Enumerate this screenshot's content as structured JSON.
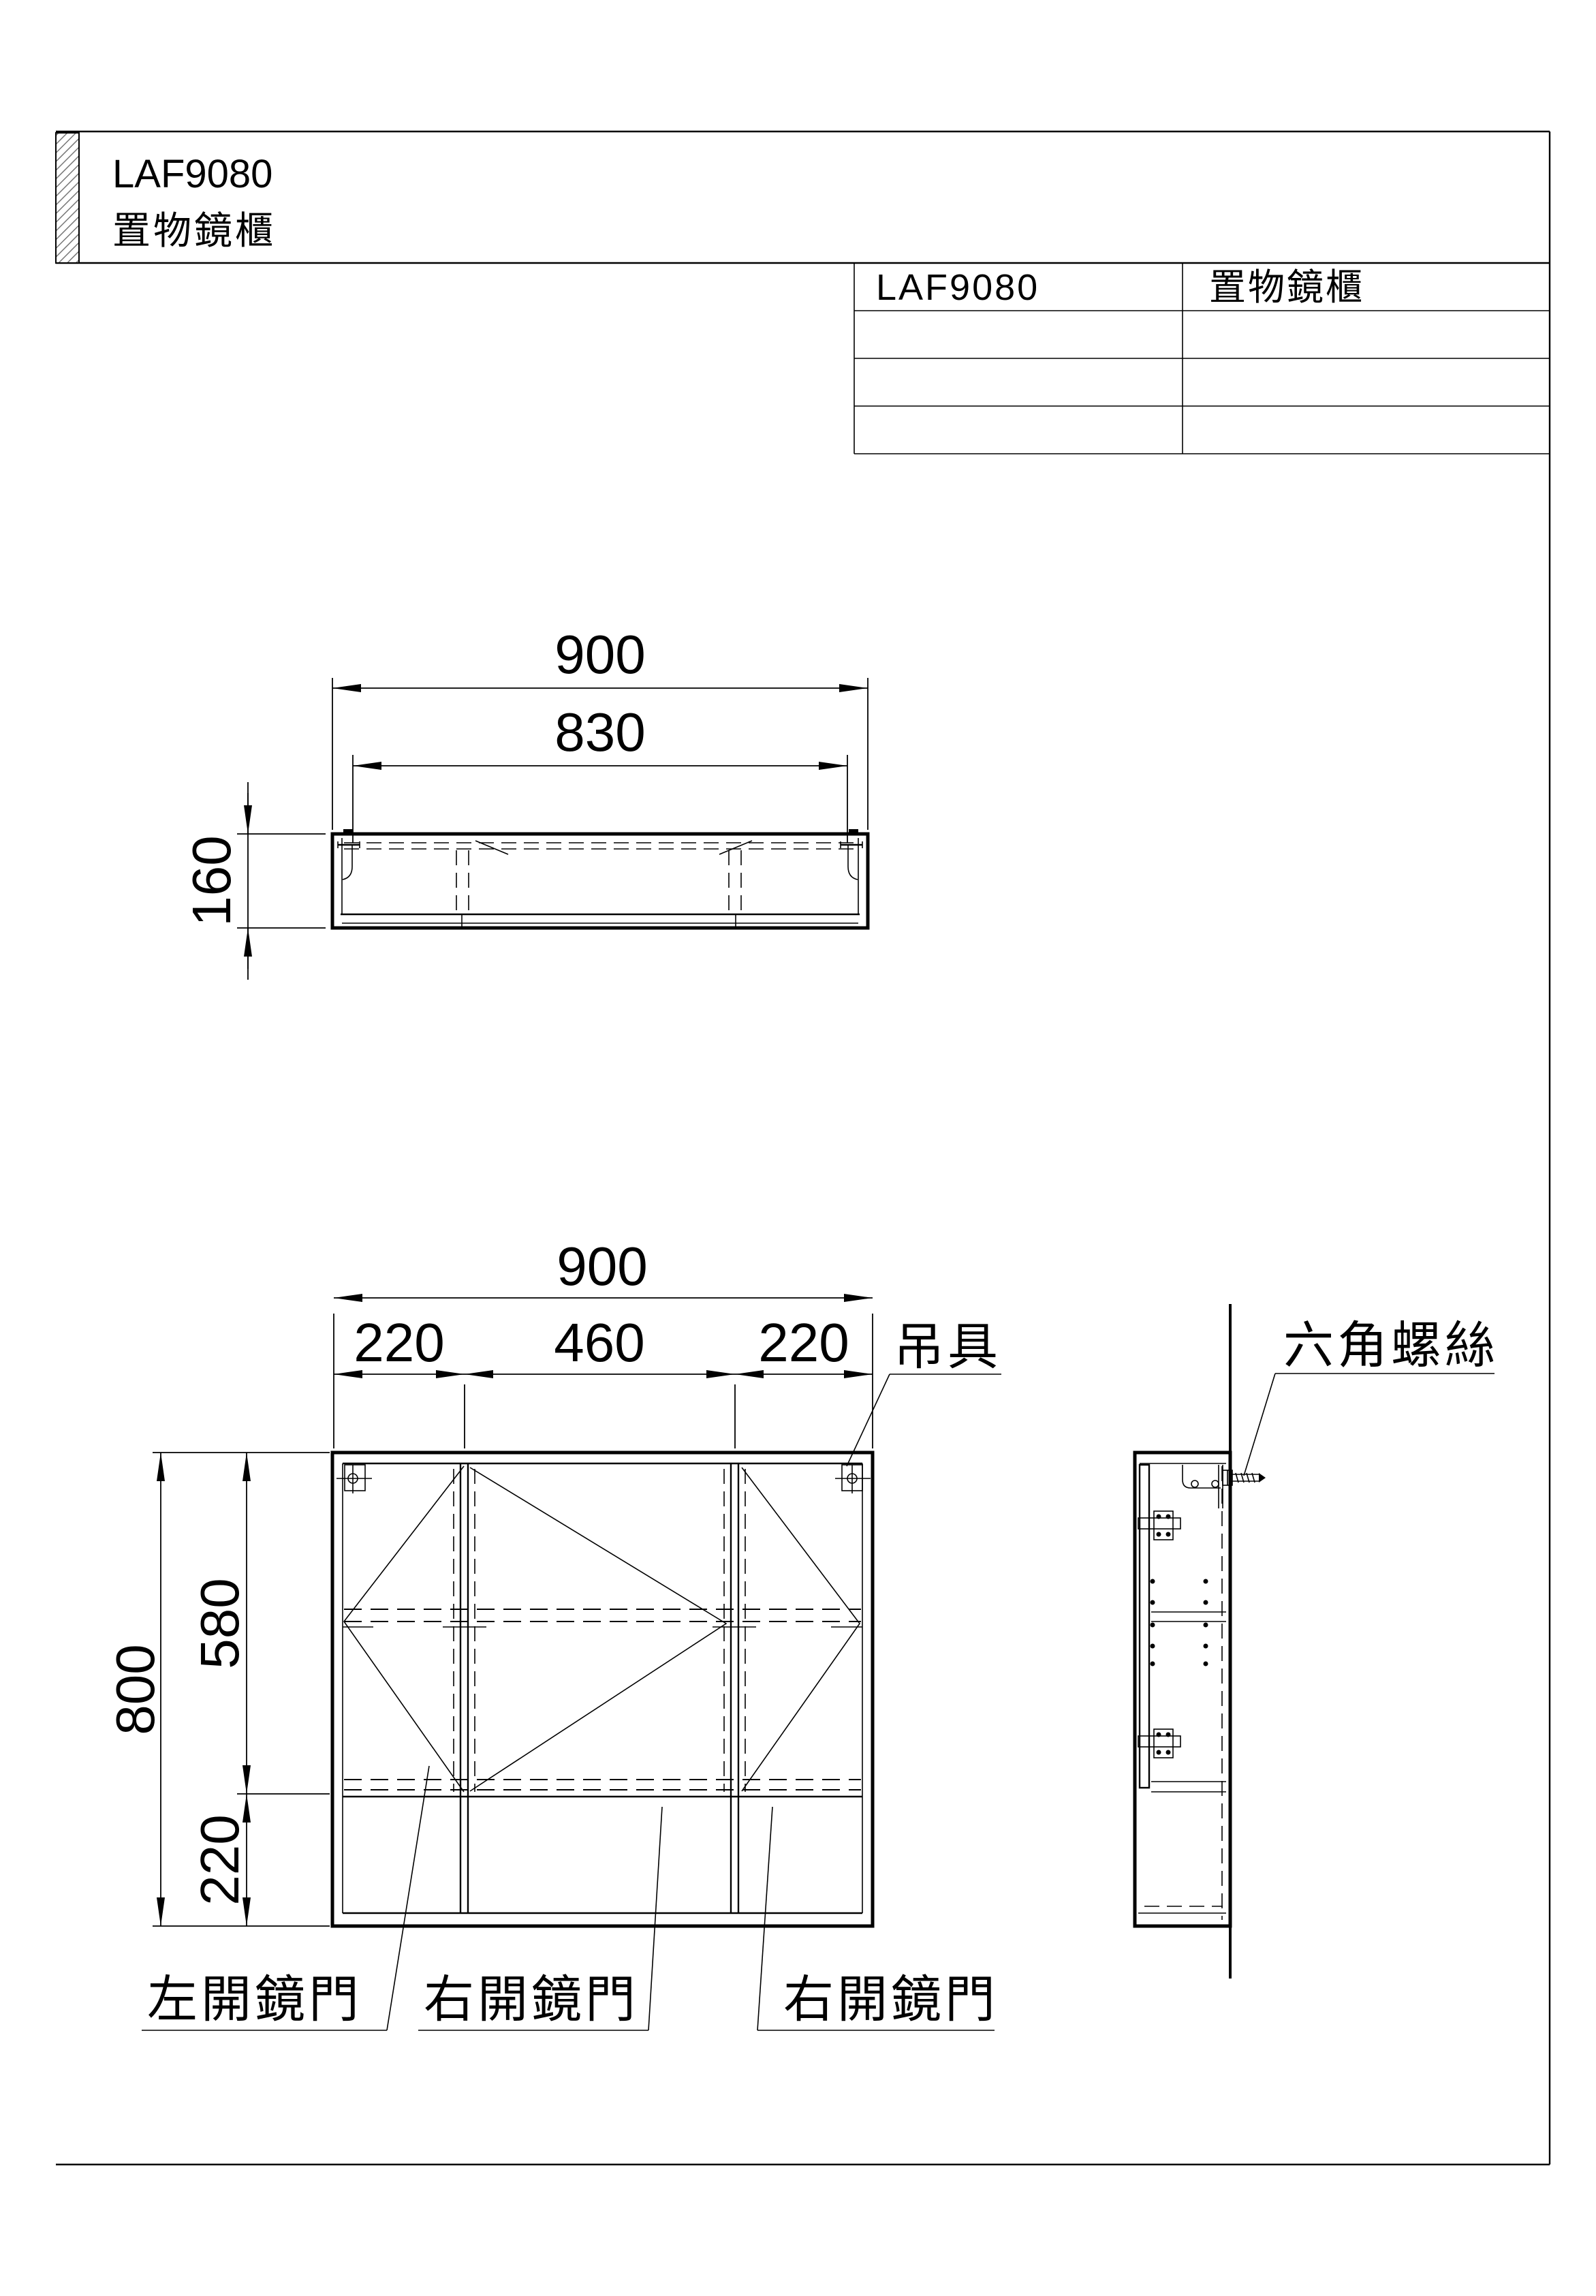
{
  "colors": {
    "ink": "#000000",
    "paper": "#ffffff"
  },
  "title_block": {
    "model": "LAF9080",
    "product_name": "置物鏡櫃"
  },
  "spec_table": {
    "model": "LAF9080",
    "product_name": "置物鏡櫃",
    "empty_rows": 3
  },
  "top_view": {
    "dim_overall_width": "900",
    "dim_hanger_span": "830",
    "dim_depth": "160"
  },
  "front_view": {
    "dim_overall_width": "900",
    "dim_left_door": "220",
    "dim_center_door": "460",
    "dim_right_door": "220",
    "dim_overall_height": "800",
    "dim_door_height": "580",
    "dim_open_shelf": "220",
    "label_hanger": "吊具",
    "label_door_left": "左開鏡門",
    "label_door_center": "右開鏡門",
    "label_door_right": "右開鏡門"
  },
  "side_view": {
    "label_hex_screw": "六角螺絲"
  }
}
